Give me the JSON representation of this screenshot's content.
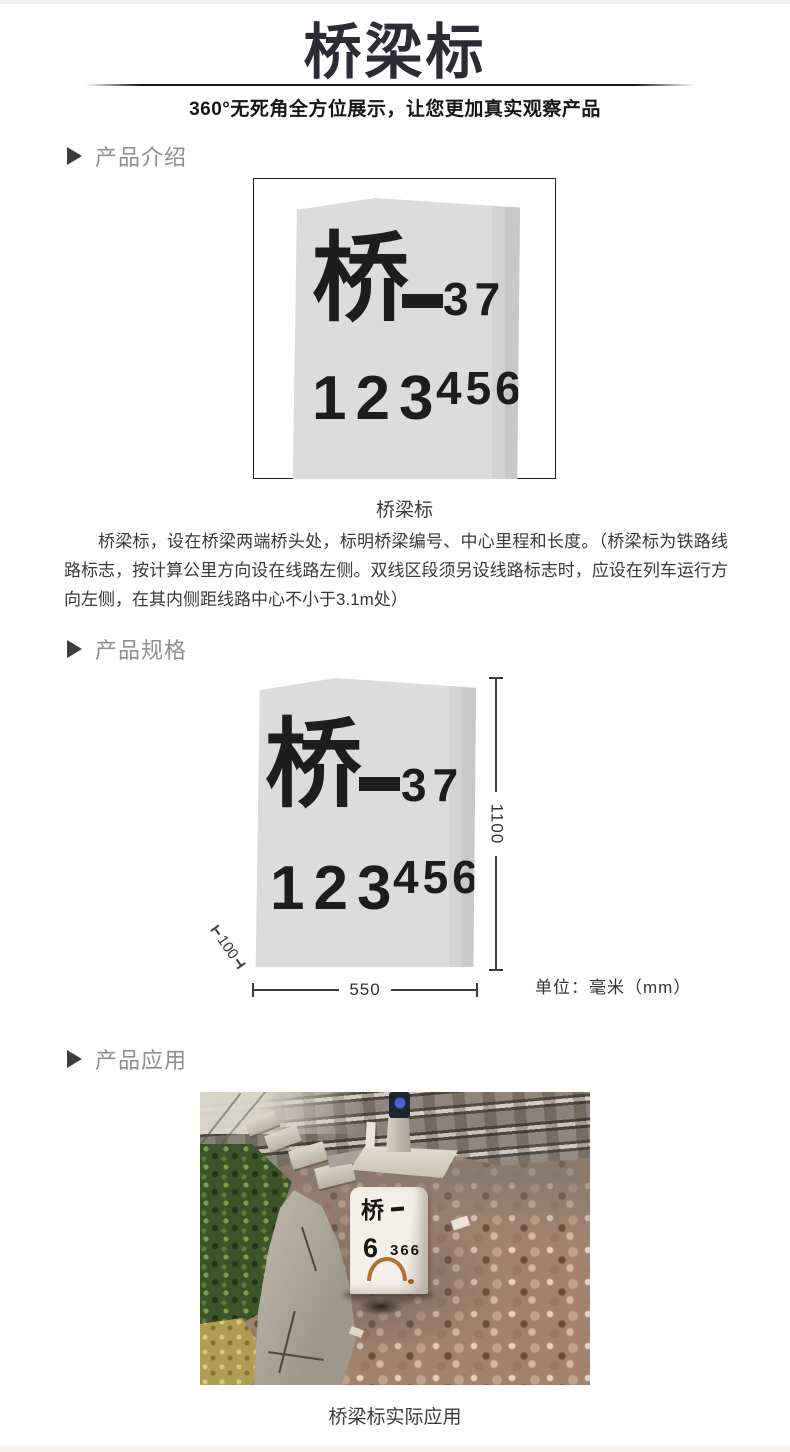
{
  "header": {
    "title": "桥梁标",
    "subtitle": "360°无死角全方位展示，让您更加真实观察产品"
  },
  "sections": {
    "intro_label": "产品介绍",
    "specs_label": "产品规格",
    "application_label": "产品应用"
  },
  "marker_sign": {
    "prefix": "桥",
    "serial": "37",
    "kilometer": "123",
    "meters": "456"
  },
  "intro": {
    "caption": "桥梁标",
    "description": "桥梁标，设在桥梁两端桥头处，标明桥梁编号、中心里程和长度。（桥梁标为铁路线路标志，按计算公里方向设在线路左侧。双线区段须另设线路标志时，应设在列车运行方向左侧，在其内侧距线路中心不小于3.1m处）"
  },
  "specs": {
    "height_mm": "1100",
    "width_mm": "550",
    "base_depth_mm": "100",
    "unit_label": "单位：毫米（mm）"
  },
  "application": {
    "caption": "桥梁标实际应用",
    "photo_marker": {
      "line1": "桥",
      "line2_left": "6",
      "line2_right": "366"
    }
  },
  "colors": {
    "title": "#2c2c35",
    "section_label": "#8f8f8f",
    "stone_fill": "#dcdcdc",
    "marker_text": "#1d1d1d",
    "dimension_line": "#3b3b3b"
  }
}
